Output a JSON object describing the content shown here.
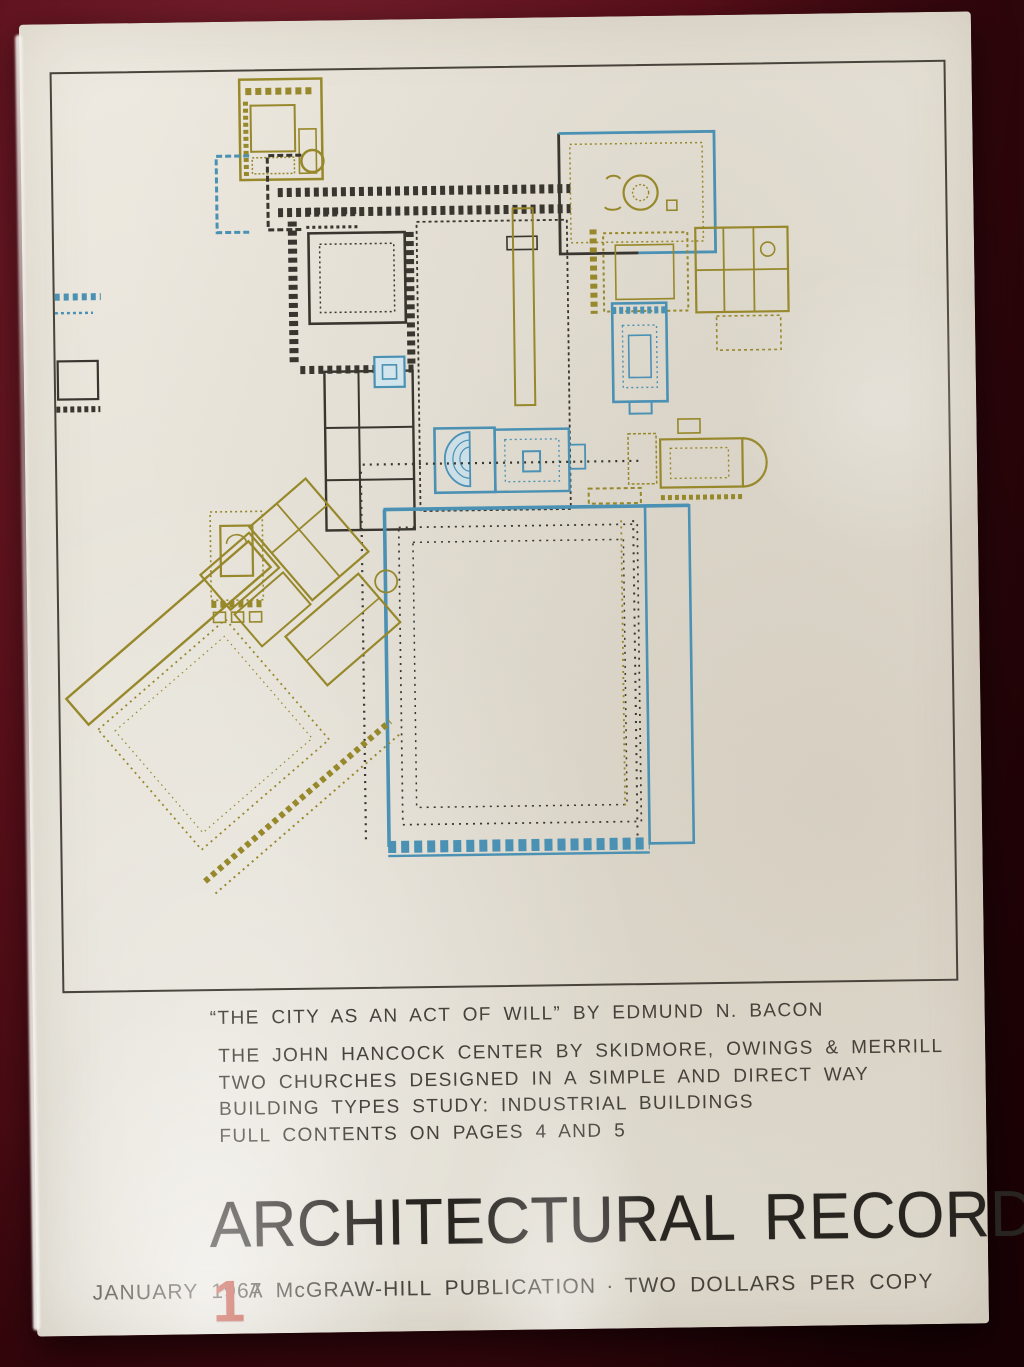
{
  "palette": {
    "photo_bg": "#5a0f1a",
    "photo_bg_dark": "#320509",
    "photo_bg_light": "#7c2330",
    "paper": "#e6e2d8",
    "frame_line": "#48443c",
    "water": "#57a8c7",
    "olive": "#97882b",
    "teal": "#4a91b4",
    "ink": "#39362f",
    "block_shades": [
      "#b9b8b3",
      "#b1b0ab",
      "#bdbcb7"
    ],
    "masthead_ink": "#282420",
    "text_ink": "#46423b",
    "red": "#bb3a28"
  },
  "contents": {
    "quote_line": "“THE CITY AS AN ACT OF WILL” BY EDMUND N. BACON",
    "lines": [
      "THE JOHN HANCOCK CENTER BY SKIDMORE, OWINGS & MERRILL",
      "TWO CHURCHES DESIGNED IN A SIMPLE AND DIRECT WAY",
      "BUILDING TYPES STUDY: INDUSTRIAL BUILDINGS",
      "FULL CONTENTS ON PAGES 4 AND 5"
    ]
  },
  "masthead": {
    "title": "ARCHITECTURAL RECORD"
  },
  "footer": {
    "date": "JANUARY 1967",
    "issue_number": "1",
    "publication": "A McGRAW-HILL PUBLICATION",
    "separator": "·",
    "price": "TWO DOLLARS PER COPY"
  }
}
